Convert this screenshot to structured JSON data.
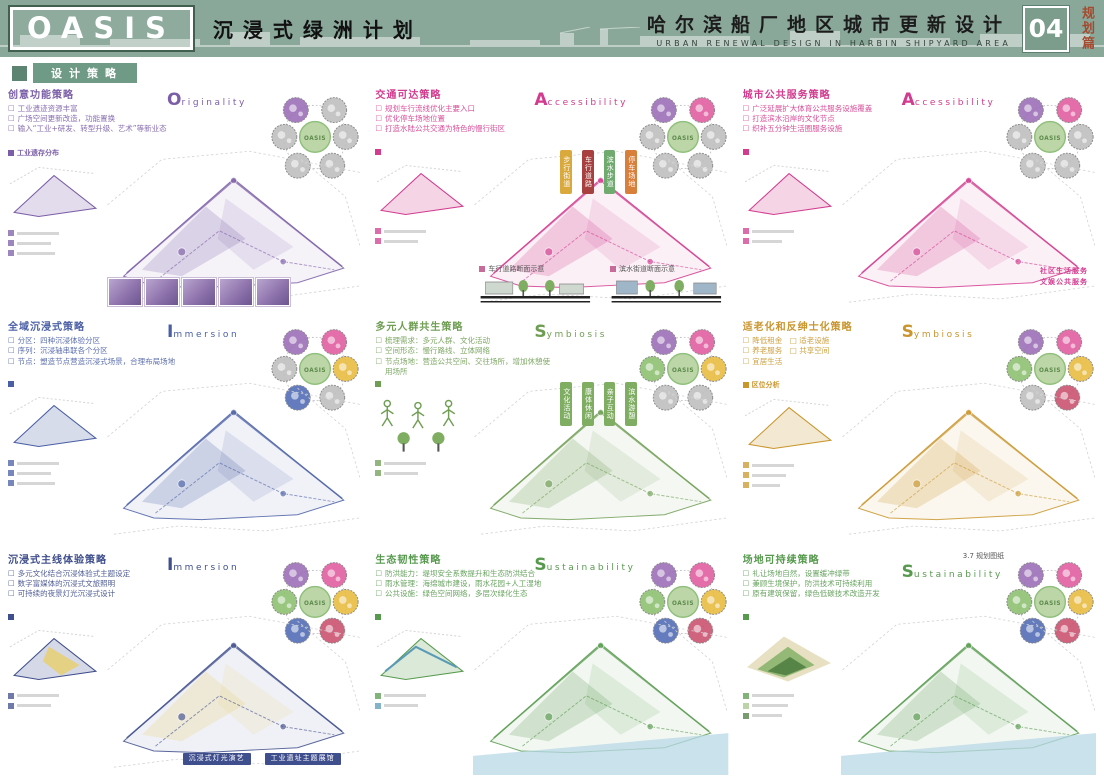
{
  "header": {
    "logo": "OASIS",
    "title_zh": "沉浸式绿洲计划",
    "right_title_zh": "哈尔滨船厂地区城市更新设计",
    "right_title_en": "URBAN RENEWAL DESIGN IN HARBIN SHIPYARD AREA",
    "page_number": "04",
    "chapter": "规划篇",
    "bg_color": "#8aa89a",
    "chapter_color": "#a34a2f"
  },
  "section_label": "设计策略",
  "flower": {
    "label": "OASIS"
  },
  "panels": [
    {
      "title": "创意功能策略",
      "accent": "#7b5ea7",
      "keyword_initial": "O",
      "keyword_rest": "riginality",
      "keyword_color": "#7b5ea7",
      "bullets": [
        "工业遗迹资源丰富",
        "广场空间更新改造，功能置换",
        "输入“工业+研发、转型升级、艺术”等新业态"
      ],
      "legend": "工业遗存分布",
      "petals": [
        "#9a6bb5",
        "#bdbdbd",
        "#bdbdbd",
        "#bdbdbd",
        "#bdbdbd",
        "#bdbdbd"
      ]
    },
    {
      "title": "交通可达策略",
      "accent": "#d23b8f",
      "keyword_initial": "A",
      "keyword_rest": "ccessibility",
      "keyword_color": "#d23b8f",
      "bullets": [
        "规划车行流线优化主要入口",
        "优化停车场地位置",
        "打造水陆公共交通为特色的慢行街区"
      ],
      "legend": "",
      "map_tags": [
        {
          "text": "步行街道",
          "color": "#d9a93c"
        },
        {
          "text": "车行道路",
          "color": "#a84040"
        },
        {
          "text": "滨水步道",
          "color": "#6faa6f"
        },
        {
          "text": "停车场地",
          "color": "#d97f3c"
        }
      ],
      "captions": [
        "车行道路断面示意",
        "滨水街道断面示意"
      ],
      "petals": [
        "#9a6bb5",
        "#e05a9e",
        "#bdbdbd",
        "#bdbdbd",
        "#bdbdbd",
        "#bdbdbd"
      ]
    },
    {
      "title": "城市公共服务策略",
      "accent": "#d23b8f",
      "keyword_initial": "A",
      "keyword_rest": "ccessibility",
      "keyword_color": "#d23b8f",
      "bullets": [
        "广泛延展扩大体育公共服务设施覆盖",
        "打造滨水沿岸的文化节点",
        "织补五分钟生活圈服务设施"
      ],
      "legend": "",
      "map_tags": [
        {
          "text": "社区生活服务",
          "color": "#d23b8f"
        },
        {
          "text": "文娱公共服务",
          "color": "#d23b8f"
        }
      ],
      "petals": [
        "#9a6bb5",
        "#e05a9e",
        "#bdbdbd",
        "#bdbdbd",
        "#bdbdbd",
        "#bdbdbd"
      ]
    },
    {
      "title": "全域沉浸式策略",
      "accent": "#4a5fa5",
      "keyword_initial": "I",
      "keyword_rest": "mmersion",
      "keyword_color": "#4a5fa5",
      "bullets": [
        "分区：四种沉浸体验分区",
        "序列：沉浸轴串联各个分区",
        "节点：塑造节点营造沉浸式场景，合理布局场地"
      ],
      "legend": "",
      "petals": [
        "#9a6bb5",
        "#e05a9e",
        "#bdbdbd",
        "#e8b93c",
        "#4f6ab5",
        "#bdbdbd"
      ]
    },
    {
      "title": "多元人群共生策略",
      "accent": "#6f9e53",
      "keyword_initial": "S",
      "keyword_rest": "ymbiosis",
      "keyword_color": "#6f9e53",
      "bullets": [
        "梳理需求：多元人群、文化活动",
        "空间形态：慢行路线、立体网络",
        "节点场地：营造公共空间、交往场所，增加休憩使用场所"
      ],
      "legend": "",
      "map_tags": [
        {
          "text": "文化活动",
          "color": "#7fae63"
        },
        {
          "text": "康体休闲",
          "color": "#7fae63"
        },
        {
          "text": "亲子互动",
          "color": "#7fae63"
        },
        {
          "text": "滨水游憩",
          "color": "#7fae63"
        }
      ],
      "petals": [
        "#9a6bb5",
        "#e05a9e",
        "#8bbf6e",
        "#e8b93c",
        "#bdbdbd",
        "#bdbdbd"
      ]
    },
    {
      "title": "适老化和反绅士化策略",
      "accent": "#c9952c",
      "keyword_initial": "S",
      "keyword_rest": "ymbiosis",
      "keyword_color": "#c9952c",
      "bullets": [
        "降低租金　□ 适老设施",
        "养老服务　□ 共享空间",
        "宜居生活"
      ],
      "legend": "区位分析",
      "petals": [
        "#9a6bb5",
        "#e05a9e",
        "#8bbf6e",
        "#e8b93c",
        "#bdbdbd",
        "#c94f6d"
      ]
    },
    {
      "title": "沉浸式主线体验策略",
      "accent": "#3f4e8c",
      "keyword_initial": "I",
      "keyword_rest": "mmersion",
      "keyword_color": "#3f4e8c",
      "bullets": [
        "多元文化结合沉浸体验式主题设定",
        "数字富媒体的沉浸式文旅照明",
        "可持续的夜景灯光沉浸式设计"
      ],
      "legend": "",
      "map_tags": [
        {
          "text": "沉浸式灯光演艺",
          "color": "#3f4e8c"
        },
        {
          "text": "工业遗址主题展馆",
          "color": "#3f4e8c"
        }
      ],
      "petals": [
        "#9a6bb5",
        "#e05a9e",
        "#8bbf6e",
        "#e8b93c",
        "#4f6ab5",
        "#c94f6d"
      ]
    },
    {
      "title": "生态韧性策略",
      "accent": "#579a4e",
      "keyword_initial": "S",
      "keyword_rest": "ustainability",
      "keyword_color": "#579a4e",
      "bullets": [
        "防洪能力：堤坝安全系数提升和生态防洪结合",
        "雨水管理：海绵城市建设，雨水花园+人工湿地",
        "公共设施：绿色空间网络，多层次绿化生态"
      ],
      "legend": "",
      "petals": [
        "#9a6bb5",
        "#e05a9e",
        "#8bbf6e",
        "#e8b93c",
        "#4f6ab5",
        "#c94f6d"
      ]
    },
    {
      "title": "场地可持续策略",
      "accent": "#579a4e",
      "keyword_initial": "S",
      "keyword_rest": "ustainability",
      "keyword_color": "#579a4e",
      "note": "3.7 规划图纸",
      "bullets": [
        "礼让场地自然，设置缓冲绿带",
        "兼顾生境保护，防洪技术可持续利用",
        "原有建筑保留，绿色低碳技术改造开发"
      ],
      "legend": "",
      "petals": [
        "#9a6bb5",
        "#e05a9e",
        "#8bbf6e",
        "#e8b93c",
        "#4f6ab5",
        "#c94f6d"
      ]
    }
  ]
}
